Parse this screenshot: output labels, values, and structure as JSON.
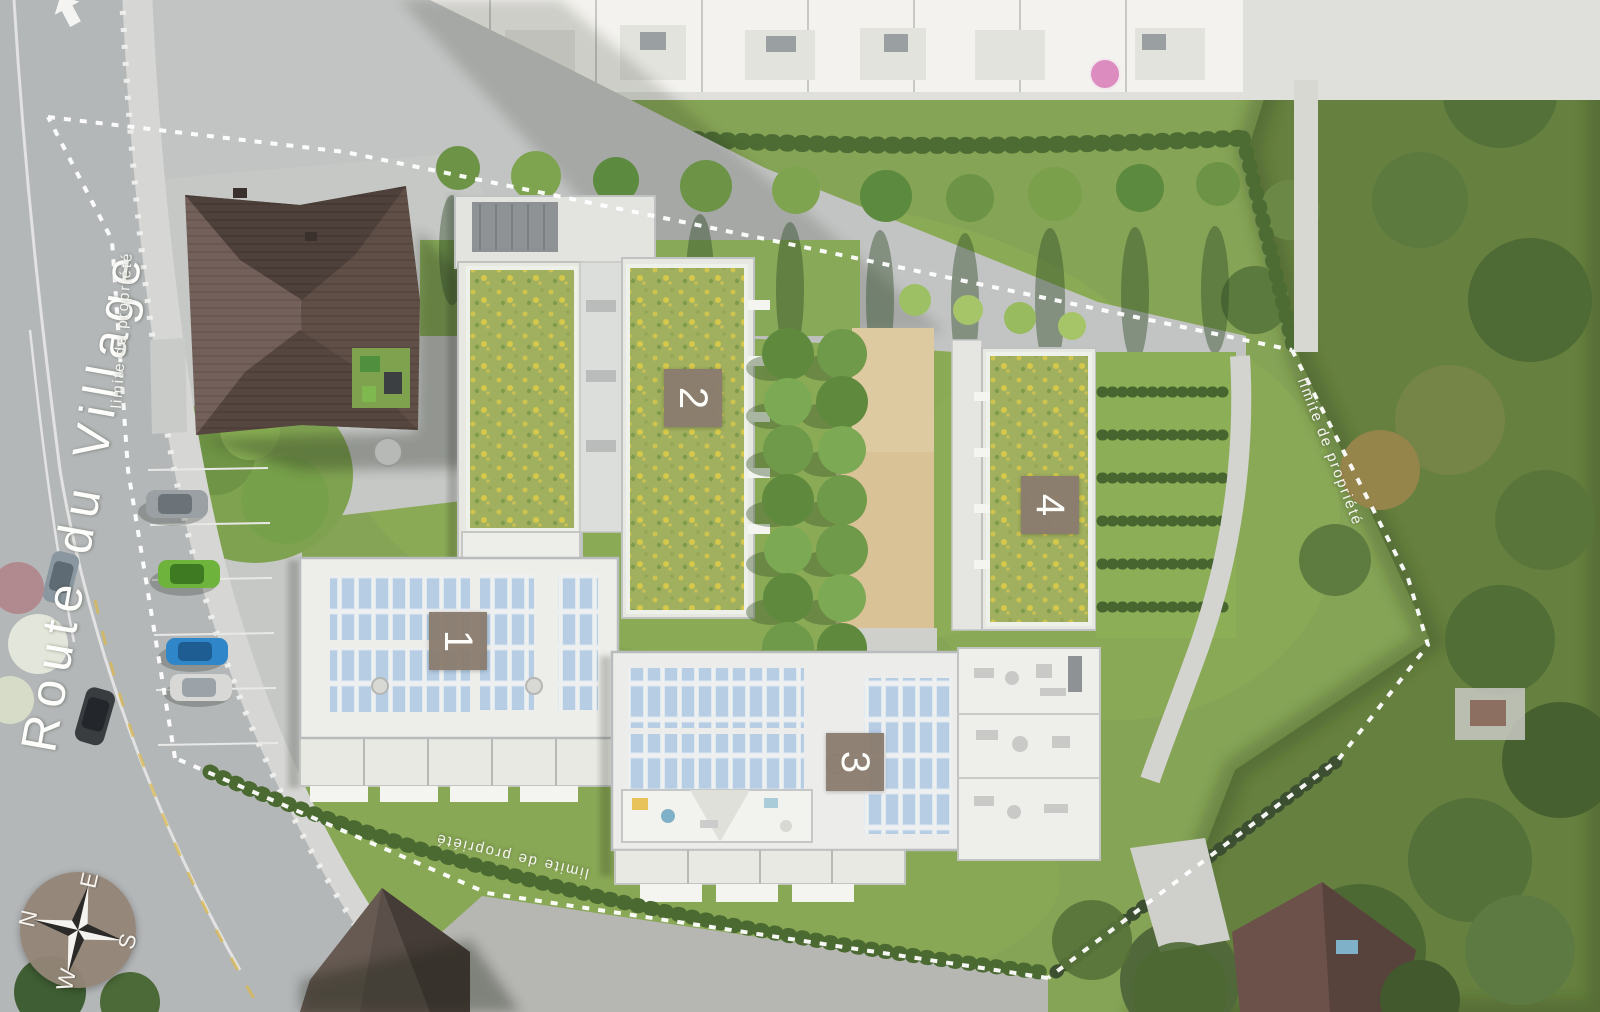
{
  "plan": {
    "road_name": "Route du Village",
    "property_boundary_label": "limite de propriété",
    "building_labels": [
      "1",
      "2",
      "3",
      "4"
    ],
    "compass": {
      "north": "N",
      "east": "E",
      "south": "S",
      "west": "W"
    },
    "colors": {
      "building_label_bg": "#8a7c6e",
      "building_label_text": "#ffffff",
      "boundary_line": "#ffffff",
      "road_name_text": "#fdfdfb",
      "compass_disc": "#948577",
      "green_roof": "#a0b05e",
      "solar_panel": "#b6cde4",
      "lawn": "#86a456",
      "sand_courtyard": "#decaa0",
      "road": "#b4b7b8"
    }
  }
}
